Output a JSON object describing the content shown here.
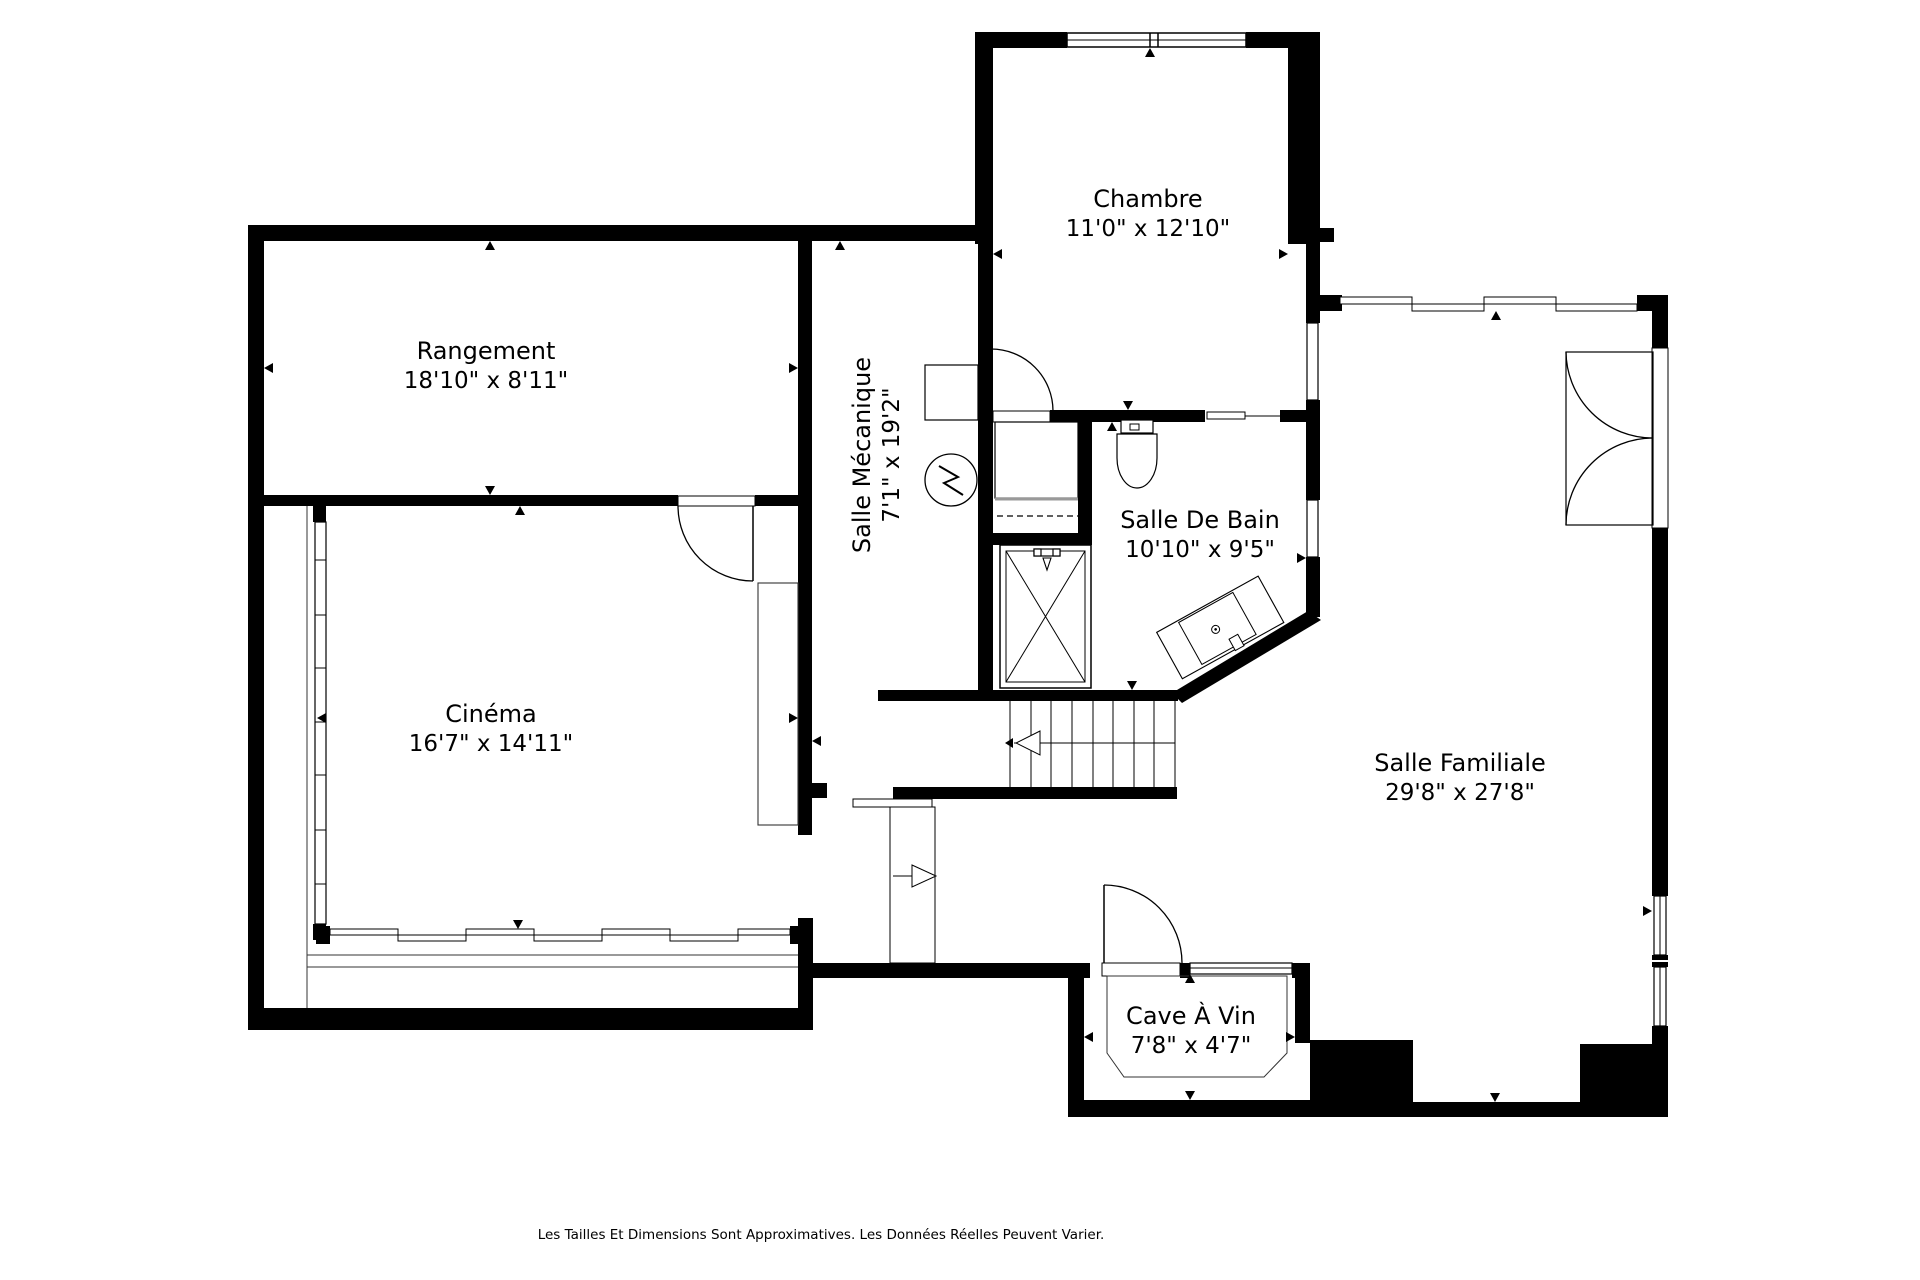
{
  "rooms": {
    "rangement": {
      "name": "Rangement",
      "dims": "18'10\" x 8'11\""
    },
    "cinema": {
      "name": "Cinéma",
      "dims": "16'7\" x 14'11\""
    },
    "chambre": {
      "name": "Chambre",
      "dims": "11'0\" x 12'10\""
    },
    "salle_mecanique": {
      "name": "Salle Mécanique",
      "dims": "7'1\" x 19'2\""
    },
    "salle_de_bain": {
      "name": "Salle De Bain",
      "dims": "10'10\" x 9'5\""
    },
    "salle_familiale": {
      "name": "Salle Familiale",
      "dims": "29'8\" x 27'8\""
    },
    "cave_a_vin": {
      "name": "Cave À Vin",
      "dims": "7'8\" x 4'7\""
    }
  },
  "footer": {
    "disclaimer": "Les Tailles Et Dimensions Sont Approximatives. Les Données Réelles Peuvent Varier."
  },
  "colors": {
    "wall": "#000000",
    "background": "#ffffff",
    "thin_line": "#333333"
  }
}
